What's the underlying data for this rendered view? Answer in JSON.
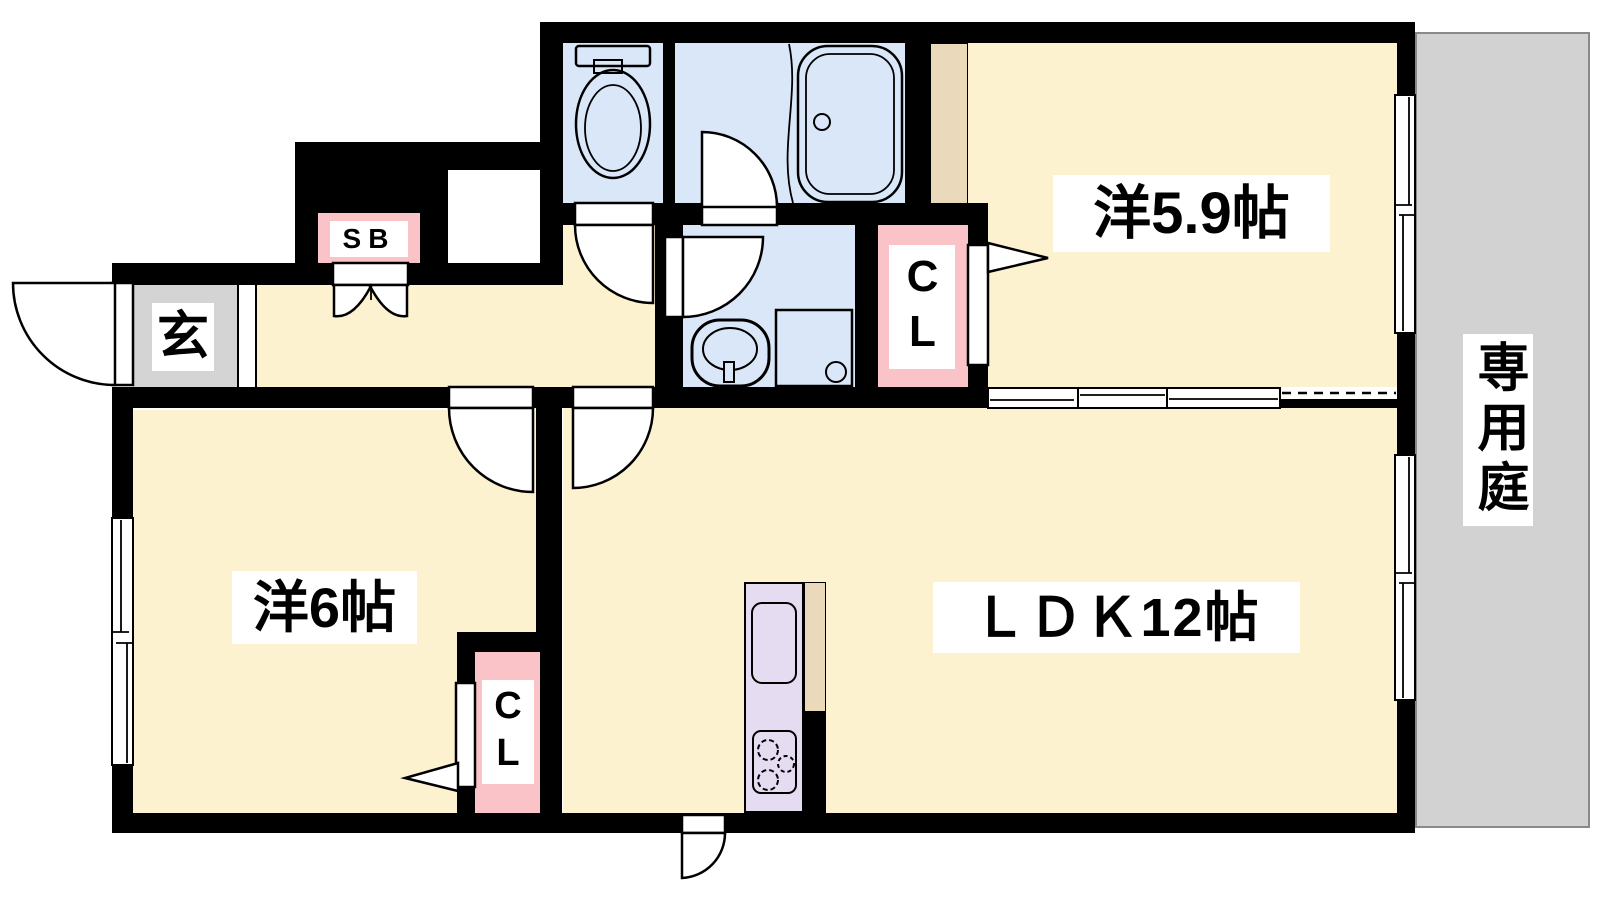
{
  "plan": {
    "type": "apartment-floor-plan",
    "layout_name": "2LDK with private garden"
  },
  "labels": {
    "room59": "洋5.9帖",
    "room6": "洋6帖",
    "ldk": "ＬＤＫ12帖",
    "garden": "専用庭",
    "entrance": "玄",
    "shoebox": "SB",
    "closet_upper": "CL",
    "closet_lower": "CL"
  },
  "fixtures": {
    "toilet": "toilet-icon",
    "bathtub": "bathtub-icon",
    "washbasin": "washbasin-icon",
    "washing_machine": "washing-machine-icon",
    "kitchen_sink": "kitchen-sink-icon",
    "stove": "stove-icon"
  },
  "colors": {
    "floor": "#fdf2d0",
    "wet": "#dae7f8",
    "closet": "#f9c3c7",
    "kitchen": "#e5dcf2",
    "genkan": "#d4d4d4",
    "garden": "#d2d2d2",
    "tan": "#ead9ba",
    "wall": "#000000"
  }
}
